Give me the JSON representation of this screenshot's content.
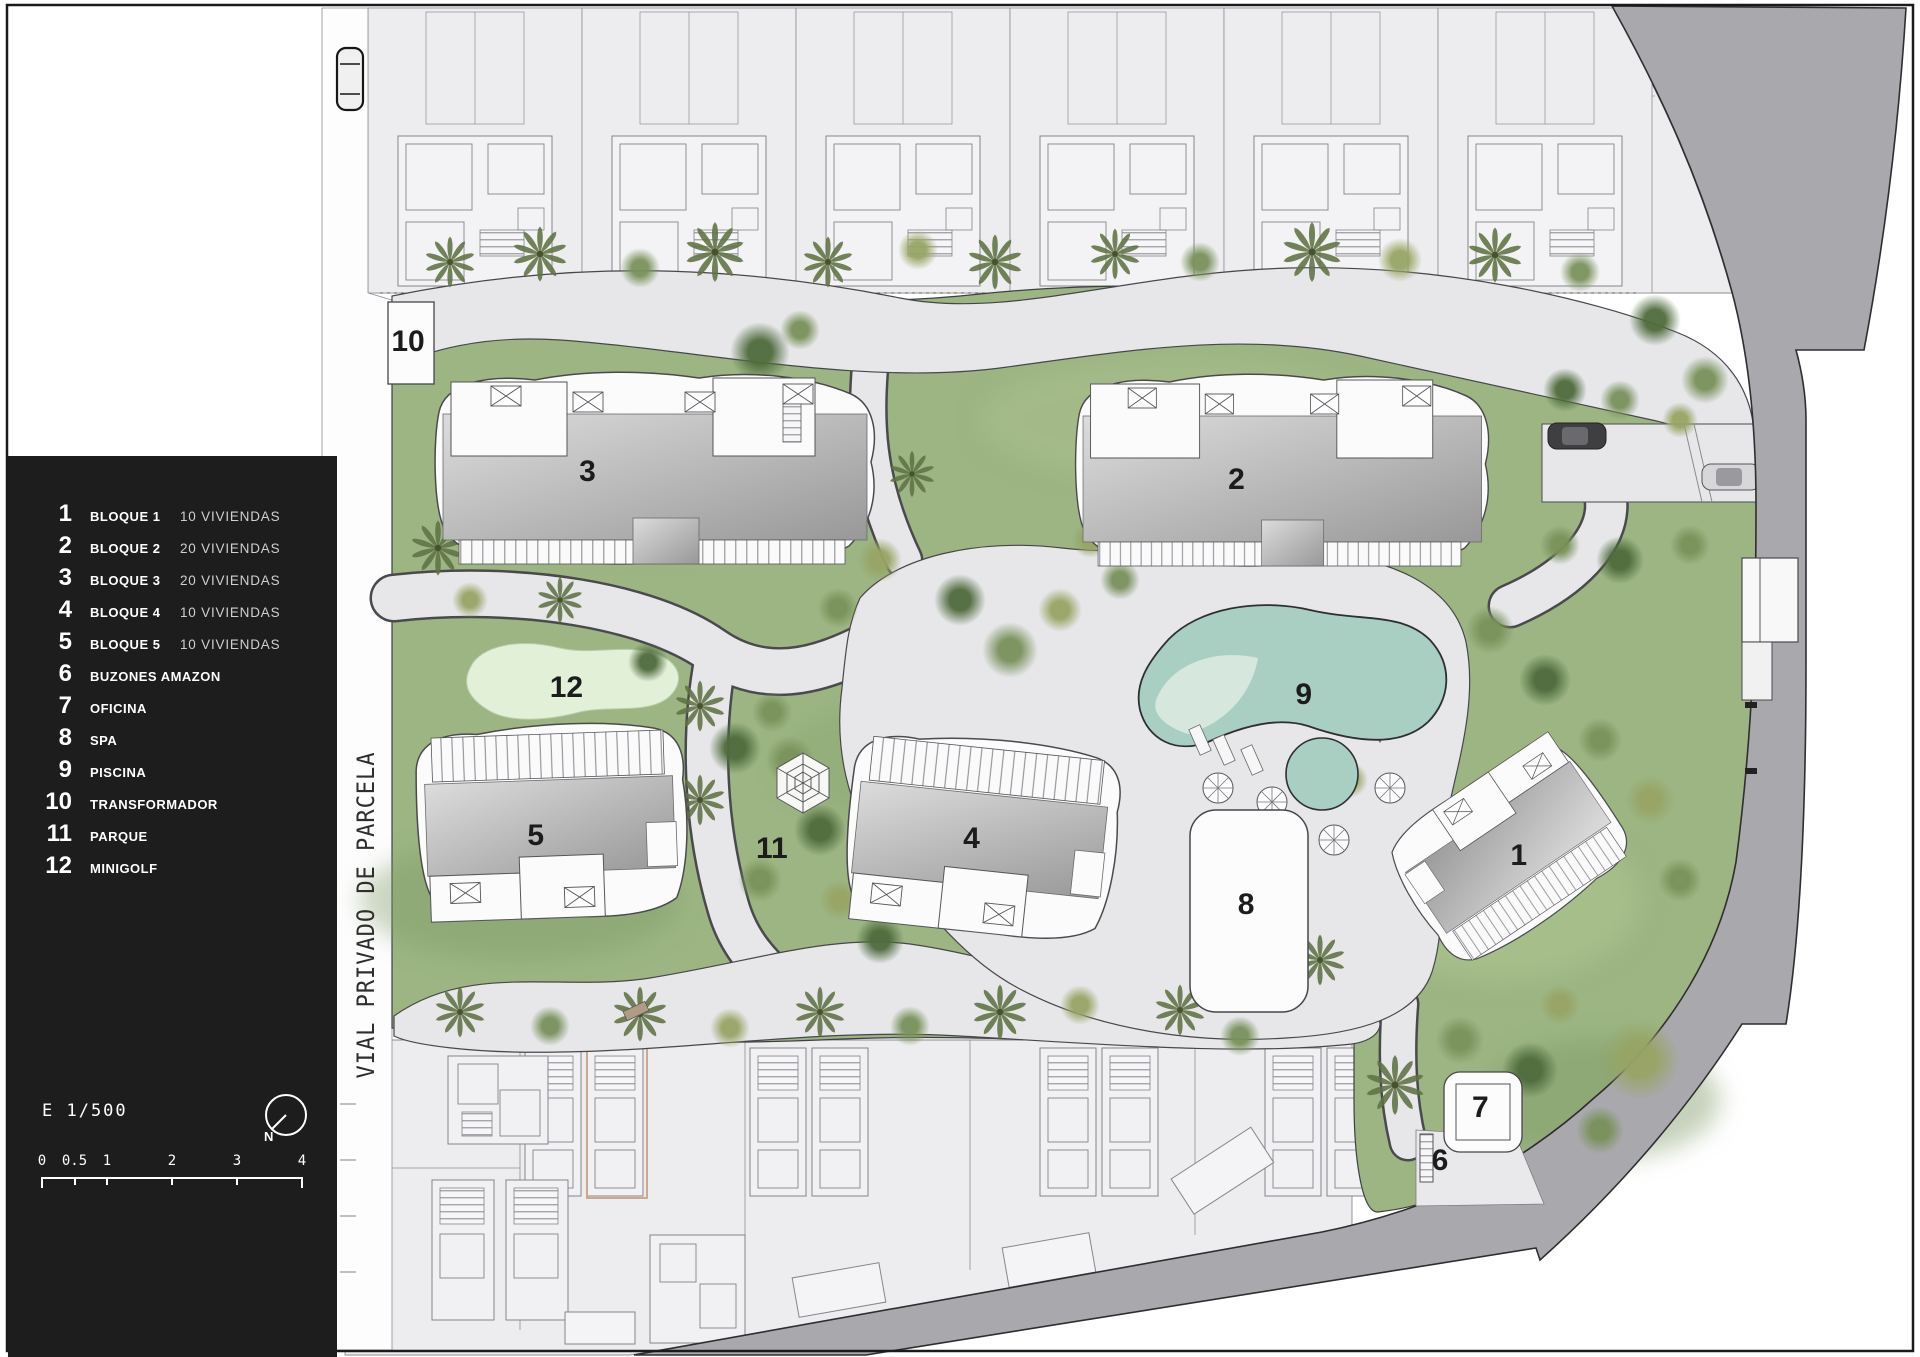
{
  "legend": {
    "items": [
      {
        "num": "1",
        "label": "BLOQUE 1",
        "detail": "10 VIVIENDAS"
      },
      {
        "num": "2",
        "label": "BLOQUE 2",
        "detail": "20 VIVIENDAS"
      },
      {
        "num": "3",
        "label": "BLOQUE 3",
        "detail": "20 VIVIENDAS"
      },
      {
        "num": "4",
        "label": "BLOQUE 4",
        "detail": "10 VIVIENDAS"
      },
      {
        "num": "5",
        "label": "BLOQUE 5",
        "detail": "10 VIVIENDAS"
      },
      {
        "num": "6",
        "label": "BUZONES AMAZON",
        "detail": ""
      },
      {
        "num": "7",
        "label": "OFICINA",
        "detail": ""
      },
      {
        "num": "8",
        "label": "SPA",
        "detail": ""
      },
      {
        "num": "9",
        "label": "PISCINA",
        "detail": ""
      },
      {
        "num": "10",
        "label": "TRANSFORMADOR",
        "detail": ""
      },
      {
        "num": "11",
        "label": "PARQUE",
        "detail": ""
      },
      {
        "num": "12",
        "label": "MINIGOLF",
        "detail": ""
      }
    ],
    "scale_text": "E 1/500",
    "north_label": "N",
    "scale_bar_ticks": [
      "0",
      "0.5",
      "1",
      "2",
      "3",
      "4"
    ]
  },
  "road_label": "VIAL PRIVADO DE PARCELA",
  "plan_labels": [
    {
      "id": "transformador",
      "text": "10",
      "x_pct": 21.25,
      "y_pct": 25.2
    },
    {
      "id": "bloque-3",
      "text": "3",
      "x_pct": 30.6,
      "y_pct": 34.8
    },
    {
      "id": "bloque-2",
      "text": "2",
      "x_pct": 64.4,
      "y_pct": 35.4
    },
    {
      "id": "minigolf",
      "text": "12",
      "x_pct": 29.5,
      "y_pct": 50.7
    },
    {
      "id": "piscina",
      "text": "9",
      "x_pct": 67.9,
      "y_pct": 51.2
    },
    {
      "id": "bloque-5",
      "text": "5",
      "x_pct": 27.9,
      "y_pct": 61.6
    },
    {
      "id": "parque",
      "text": "11",
      "x_pct": 40.2,
      "y_pct": 62.6
    },
    {
      "id": "bloque-4",
      "text": "4",
      "x_pct": 50.6,
      "y_pct": 61.8
    },
    {
      "id": "spa",
      "text": "8",
      "x_pct": 64.9,
      "y_pct": 66.7
    },
    {
      "id": "bloque-1",
      "text": "1",
      "x_pct": 79.1,
      "y_pct": 63.1
    },
    {
      "id": "oficina",
      "text": "7",
      "x_pct": 77.1,
      "y_pct": 81.65
    },
    {
      "id": "buzones",
      "text": "6",
      "x_pct": 75.0,
      "y_pct": 85.55
    }
  ],
  "colors": {
    "legend_bg": "#1d1d1d",
    "lawn": "#9cb583",
    "path": "#e7e7ea",
    "boundary_road": "#a9a9ad",
    "pool": "#a9cfc3",
    "pool_shallow": "#d8e9df",
    "minigolf": "#e3f0d8",
    "roof_light": "#dcdcdc",
    "roof_dark": "#989898",
    "villa_plot": "#ededef",
    "outline": "#3c3c3c",
    "highlight_villa": "#c9a183"
  }
}
